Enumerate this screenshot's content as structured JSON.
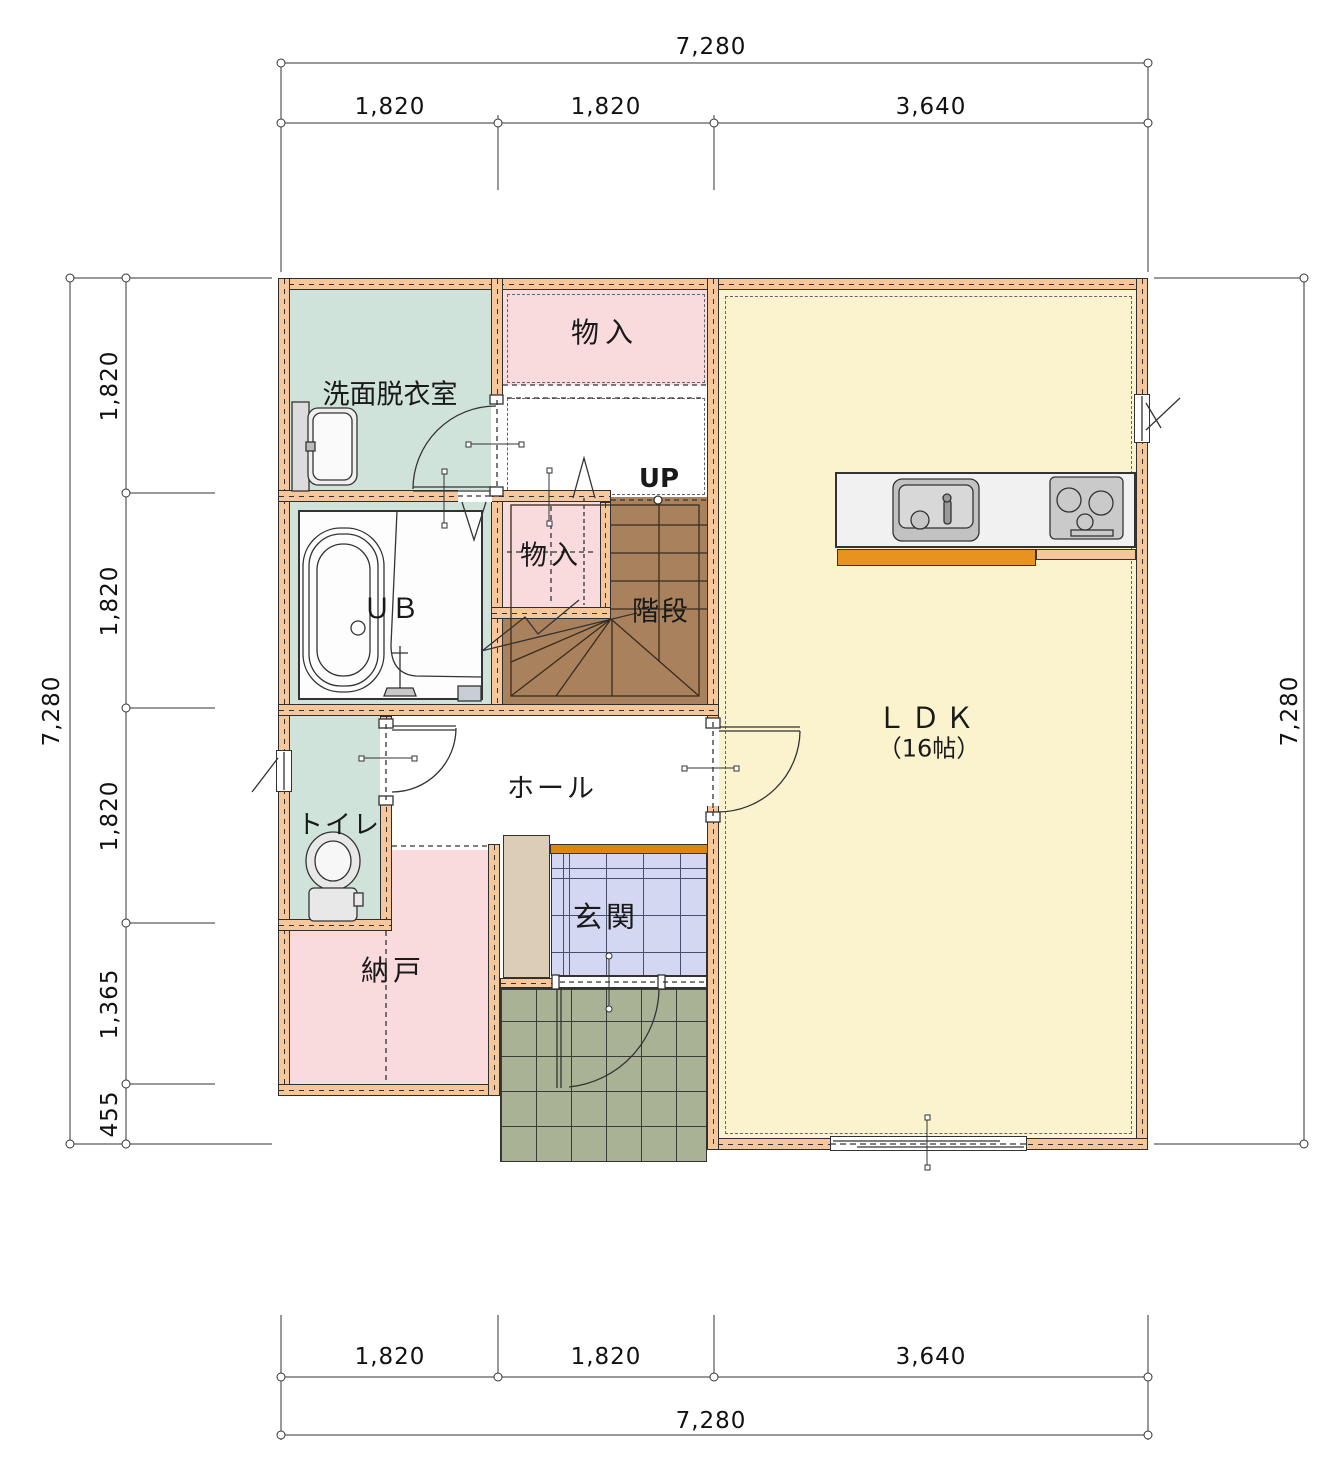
{
  "rooms": {
    "washroom": {
      "label": "洗面脱衣室"
    },
    "storage_top": {
      "label": "物入"
    },
    "storage_small": {
      "label": "物入"
    },
    "unit_bath": {
      "label": "ＵＢ"
    },
    "stairs": {
      "label": "階段",
      "up": "UP"
    },
    "hall": {
      "label": "ホール"
    },
    "toilet": {
      "label": "トイレ"
    },
    "storage_room": {
      "label": "納戸"
    },
    "entrance": {
      "label": "玄関"
    },
    "ldk": {
      "label": "ＬＤＫ",
      "size": "（16帖）"
    }
  },
  "dims": {
    "top": {
      "total": "7,280",
      "segments": [
        "1,820",
        "1,820",
        "3,640"
      ]
    },
    "bottom": {
      "total": "7,280",
      "segments": [
        "1,820",
        "1,820",
        "3,640"
      ]
    },
    "left": {
      "total": "7,280",
      "segments": [
        "1,820",
        "1,820",
        "1,820",
        "1,365",
        "455"
      ]
    },
    "right": {
      "total": "7,280"
    }
  },
  "colors": {
    "wall": "#F5C79B",
    "ldk": "#FAF3CE",
    "teal_room": "#CFE3DB",
    "pink_room": "#F9DADD",
    "stairs": "#A9815C",
    "porch_tile": "#A9B295",
    "entrance_tile": "#D4D7F1",
    "cabinet": "#DBCDB6",
    "kamachi": "#D9890D",
    "counter": "#F1F1F1",
    "kitchen_cabinet": "#E8921F"
  }
}
